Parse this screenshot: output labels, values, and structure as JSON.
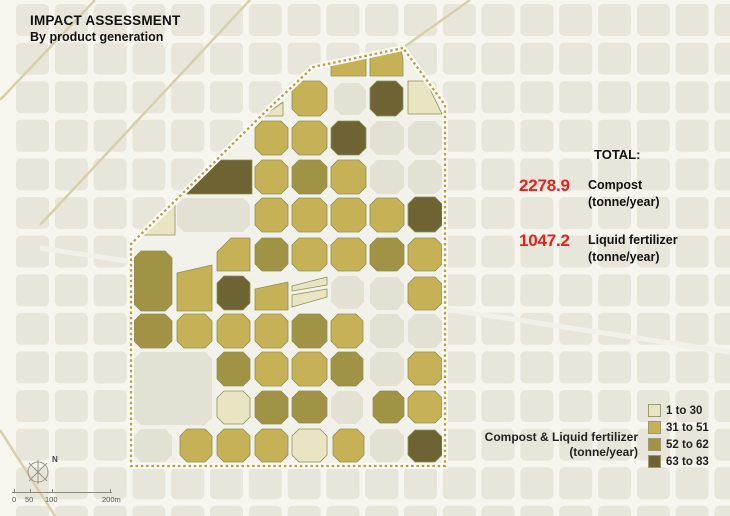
{
  "title": {
    "line1": "IMPACT ASSESSMENT",
    "line2": "By product generation"
  },
  "totals": {
    "heading": "TOTAL:",
    "value_color": "#e2231e",
    "items": [
      {
        "value": "2278.9",
        "label": "Compost",
        "unit": "(tonne/year)"
      },
      {
        "value": "1047.2",
        "label": "Liquid fertilizer",
        "unit": "(tonne/year)"
      }
    ]
  },
  "legend": {
    "caption_line1": "Compost & Liquid fertilizer",
    "caption_line2": "(tonne/year)",
    "classes": [
      {
        "label": "1 to 30",
        "color": "#e9e5c3"
      },
      {
        "label": "31 to 51",
        "color": "#c6b157"
      },
      {
        "label": "52 to 62",
        "color": "#a19345"
      },
      {
        "label": "63 to 83",
        "color": "#6e6333"
      }
    ]
  },
  "scalebar": {
    "labels": [
      "0",
      "50",
      "100",
      "200m"
    ],
    "north_label": "N"
  },
  "map": {
    "colors": {
      "street_bg": "#f6f5ee",
      "building": "#e8e6db",
      "building_in_district": "#e3e1d4",
      "district_street": "#f3f2ea",
      "road_tan": "#d8cfab",
      "boundary": "#b99f4a",
      "boundary_casing": "#fbfaf4",
      "block_stroke": "#8b9256"
    },
    "district_boundary": [
      [
        403,
        48
      ],
      [
        313,
        67
      ],
      [
        262,
        115
      ],
      [
        180,
        196
      ],
      [
        131,
        244
      ],
      [
        131,
        466
      ],
      [
        445,
        466
      ],
      [
        445,
        105
      ]
    ],
    "diagonal_roads": [
      [
        95,
        0,
        0,
        100
      ],
      [
        250,
        0,
        40,
        225
      ],
      [
        55,
        516,
        0,
        430
      ],
      [
        470,
        0,
        404,
        47
      ]
    ],
    "avenue": [
      40,
      248,
      730,
      352
    ],
    "blocks": [
      {
        "x": 334,
        "y": 83,
        "w": 32,
        "h": 32,
        "c": 0
      },
      {
        "x": 370,
        "y": 121,
        "w": 34,
        "h": 34,
        "c": 0
      },
      {
        "x": 408,
        "y": 121,
        "w": 34,
        "h": 34,
        "c": 0
      },
      {
        "x": 370,
        "y": 160,
        "w": 34,
        "h": 34,
        "c": 0
      },
      {
        "x": 408,
        "y": 160,
        "w": 34,
        "h": 34,
        "c": 0
      },
      {
        "x": 177,
        "y": 198,
        "w": 73,
        "h": 34,
        "c": 0
      },
      {
        "x": 331,
        "y": 276,
        "w": 33,
        "h": 33,
        "c": 0
      },
      {
        "x": 370,
        "y": 277,
        "w": 34,
        "h": 33,
        "c": 0
      },
      {
        "x": 370,
        "y": 314,
        "w": 34,
        "h": 34,
        "c": 0
      },
      {
        "x": 408,
        "y": 314,
        "w": 34,
        "h": 34,
        "c": 0
      },
      {
        "x": 370,
        "y": 352,
        "w": 34,
        "h": 34,
        "c": 0
      },
      {
        "x": 134,
        "y": 352,
        "w": 78,
        "h": 73,
        "c": 0
      },
      {
        "x": 331,
        "y": 391,
        "w": 32,
        "h": 33,
        "c": 0
      },
      {
        "x": 134,
        "y": 429,
        "w": 38,
        "h": 33,
        "c": 0
      },
      {
        "x": 370,
        "y": 429,
        "w": 34,
        "h": 33,
        "c": 0
      },
      {
        "pts": [
          [
            331,
            64
          ],
          [
            366,
            57
          ],
          [
            366,
            76
          ],
          [
            331,
            76
          ]
        ],
        "c": 2
      },
      {
        "pts": [
          [
            370,
            55
          ],
          [
            401,
            49
          ],
          [
            403,
            60
          ],
          [
            403,
            76
          ],
          [
            370,
            76
          ]
        ],
        "c": 2
      },
      {
        "pts": [
          [
            283,
            102
          ],
          [
            283,
            116
          ],
          [
            263,
            116
          ]
        ],
        "c": 1
      },
      {
        "x": 292,
        "y": 81,
        "w": 35,
        "h": 35,
        "c": 2
      },
      {
        "x": 370,
        "y": 81,
        "w": 33,
        "h": 35,
        "c": 4
      },
      {
        "pts": [
          [
            408,
            81
          ],
          [
            426,
            81
          ],
          [
            442,
            114
          ],
          [
            408,
            114
          ]
        ],
        "c": 1
      },
      {
        "x": 255,
        "y": 121,
        "w": 33,
        "h": 34,
        "c": 2
      },
      {
        "x": 292,
        "y": 121,
        "w": 35,
        "h": 34,
        "c": 2
      },
      {
        "x": 331,
        "y": 121,
        "w": 35,
        "h": 34,
        "c": 4
      },
      {
        "pts": [
          [
            217,
            160
          ],
          [
            252,
            160
          ],
          [
            252,
            194
          ],
          [
            180,
            194
          ]
        ],
        "c": 4
      },
      {
        "x": 255,
        "y": 160,
        "w": 33,
        "h": 34,
        "c": 2
      },
      {
        "x": 292,
        "y": 160,
        "w": 35,
        "h": 34,
        "c": 3
      },
      {
        "x": 331,
        "y": 160,
        "w": 35,
        "h": 34,
        "c": 2
      },
      {
        "pts": [
          [
            175,
            202
          ],
          [
            175,
            235
          ],
          [
            137,
            235
          ]
        ],
        "c": 1
      },
      {
        "x": 255,
        "y": 198,
        "w": 33,
        "h": 34,
        "c": 2
      },
      {
        "x": 292,
        "y": 198,
        "w": 35,
        "h": 34,
        "c": 2
      },
      {
        "x": 331,
        "y": 198,
        "w": 35,
        "h": 34,
        "c": 2
      },
      {
        "x": 370,
        "y": 198,
        "w": 34,
        "h": 34,
        "c": 2
      },
      {
        "x": 408,
        "y": 197,
        "w": 34,
        "h": 35,
        "c": 4
      },
      {
        "x": 134,
        "y": 251,
        "w": 38,
        "h": 60,
        "c": 3
      },
      {
        "pts": [
          [
            177,
            273
          ],
          [
            212,
            265
          ],
          [
            212,
            311
          ],
          [
            177,
            311
          ]
        ],
        "c": 2
      },
      {
        "pts": [
          [
            231,
            238
          ],
          [
            250,
            238
          ],
          [
            250,
            271
          ],
          [
            217,
            271
          ],
          [
            217,
            252
          ]
        ],
        "c": 2
      },
      {
        "x": 255,
        "y": 238,
        "w": 33,
        "h": 33,
        "c": 3
      },
      {
        "x": 292,
        "y": 238,
        "w": 35,
        "h": 33,
        "c": 2
      },
      {
        "x": 331,
        "y": 238,
        "w": 35,
        "h": 33,
        "c": 2
      },
      {
        "x": 370,
        "y": 238,
        "w": 34,
        "h": 33,
        "c": 3
      },
      {
        "x": 408,
        "y": 238,
        "w": 34,
        "h": 33,
        "c": 2
      },
      {
        "x": 217,
        "y": 276,
        "w": 33,
        "h": 34,
        "c": 4
      },
      {
        "pts": [
          [
            255,
            289
          ],
          [
            288,
            282
          ],
          [
            288,
            310
          ],
          [
            255,
            310
          ]
        ],
        "c": 2
      },
      {
        "pts": [
          [
            292,
            286
          ],
          [
            327,
            277
          ],
          [
            327,
            285
          ],
          [
            292,
            291
          ]
        ],
        "c": 1
      },
      {
        "pts": [
          [
            292,
            295
          ],
          [
            327,
            289
          ],
          [
            327,
            297
          ],
          [
            292,
            307
          ]
        ],
        "c": 1
      },
      {
        "x": 408,
        "y": 277,
        "w": 34,
        "h": 33,
        "c": 2
      },
      {
        "x": 134,
        "y": 314,
        "w": 38,
        "h": 34,
        "c": 3
      },
      {
        "x": 177,
        "y": 314,
        "w": 35,
        "h": 34,
        "c": 2
      },
      {
        "x": 217,
        "y": 314,
        "w": 33,
        "h": 34,
        "c": 2
      },
      {
        "x": 255,
        "y": 314,
        "w": 33,
        "h": 34,
        "c": 2
      },
      {
        "x": 292,
        "y": 314,
        "w": 35,
        "h": 34,
        "c": 3
      },
      {
        "x": 331,
        "y": 314,
        "w": 32,
        "h": 34,
        "c": 2
      },
      {
        "x": 217,
        "y": 352,
        "w": 33,
        "h": 34,
        "c": 3
      },
      {
        "x": 255,
        "y": 352,
        "w": 33,
        "h": 34,
        "c": 2
      },
      {
        "x": 292,
        "y": 352,
        "w": 35,
        "h": 34,
        "c": 2
      },
      {
        "x": 331,
        "y": 352,
        "w": 32,
        "h": 34,
        "c": 3
      },
      {
        "x": 408,
        "y": 352,
        "w": 34,
        "h": 33,
        "c": 2
      },
      {
        "x": 217,
        "y": 391,
        "w": 33,
        "h": 33,
        "c": 1
      },
      {
        "x": 255,
        "y": 391,
        "w": 33,
        "h": 33,
        "c": 3
      },
      {
        "x": 292,
        "y": 391,
        "w": 35,
        "h": 32,
        "c": 3
      },
      {
        "x": 373,
        "y": 391,
        "w": 31,
        "h": 32,
        "c": 3
      },
      {
        "x": 408,
        "y": 391,
        "w": 34,
        "h": 32,
        "c": 2
      },
      {
        "x": 180,
        "y": 429,
        "w": 32,
        "h": 33,
        "c": 2
      },
      {
        "x": 217,
        "y": 429,
        "w": 33,
        "h": 33,
        "c": 2
      },
      {
        "x": 255,
        "y": 429,
        "w": 33,
        "h": 33,
        "c": 2
      },
      {
        "x": 292,
        "y": 429,
        "w": 35,
        "h": 33,
        "c": 1
      },
      {
        "x": 333,
        "y": 429,
        "w": 31,
        "h": 33,
        "c": 2
      },
      {
        "x": 408,
        "y": 430,
        "w": 34,
        "h": 32,
        "c": 4
      }
    ]
  }
}
